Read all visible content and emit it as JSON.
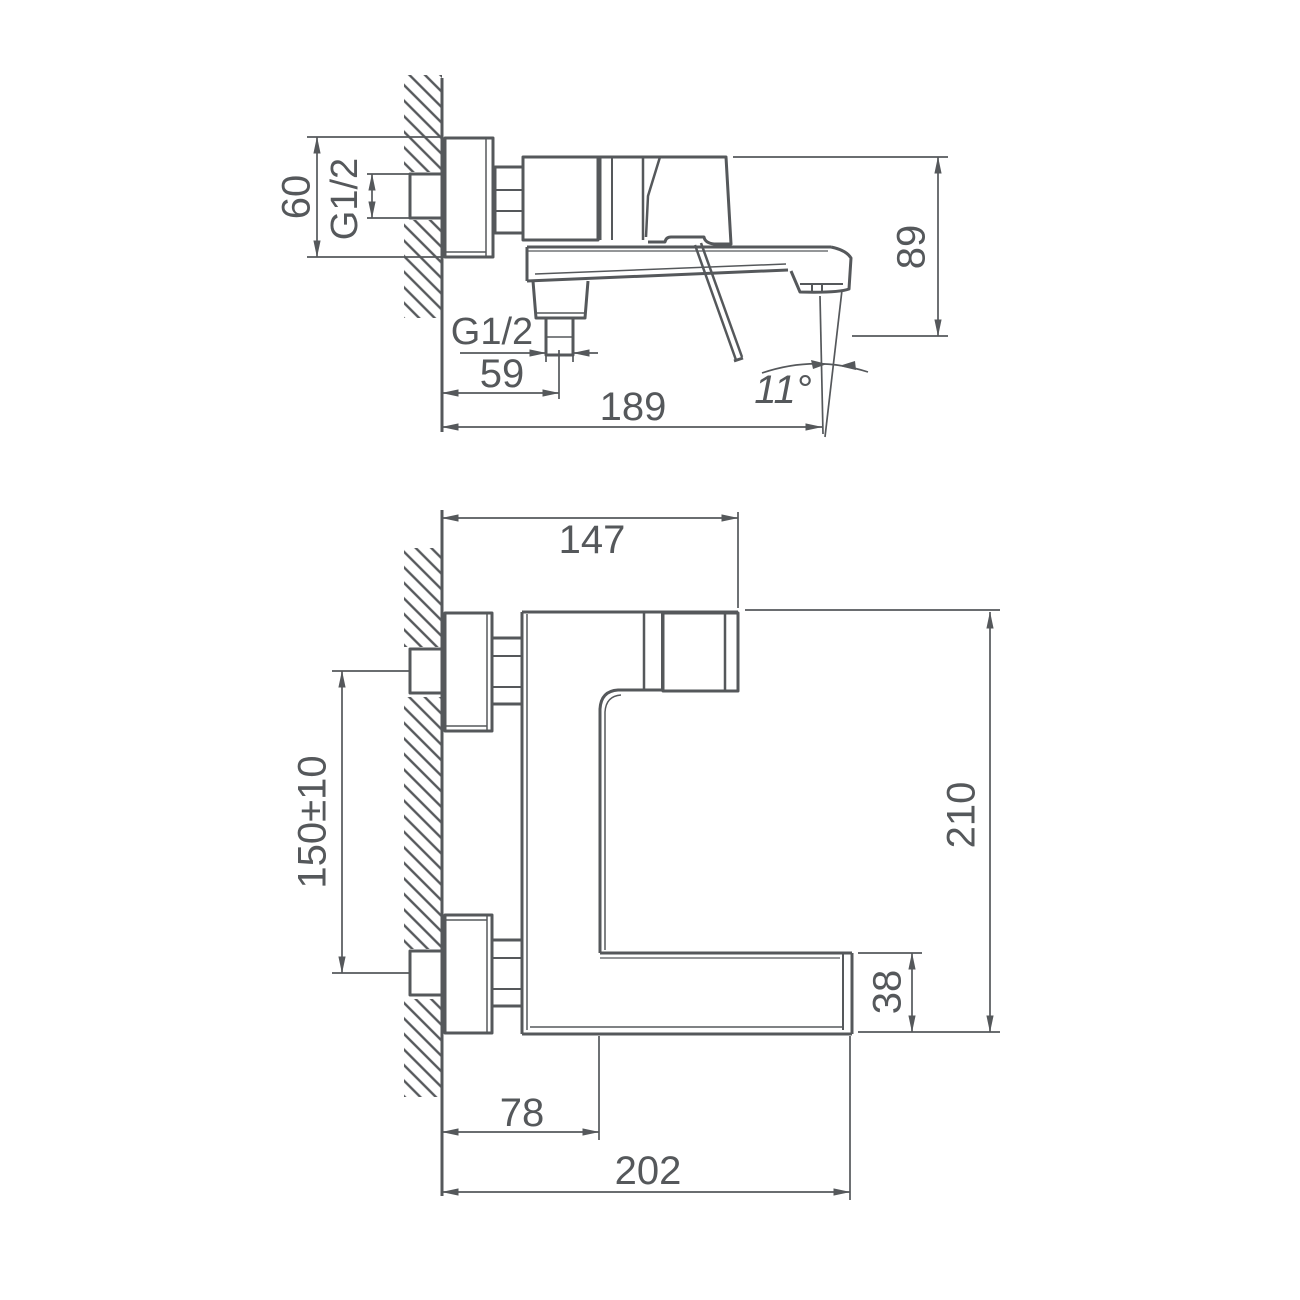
{
  "document": {
    "type": "technical-dimension-drawing",
    "subject": "wall-mounted single-lever bath mixer faucet, two orthographic views",
    "background_color": "#ffffff",
    "line_color": "#55585b"
  },
  "dims": {
    "d60": "60",
    "g12_inlet": "G1/2",
    "d89": "89",
    "g12_outlet": "G1/2",
    "d59": "59",
    "d189": "189",
    "a11": "11°",
    "d147": "147",
    "d150": "150±10",
    "d210": "210",
    "d38": "38",
    "d78": "78",
    "d202": "202"
  },
  "views": {
    "side_view": {
      "label": "side view (spout profile)",
      "dimensions": [
        "60",
        "G1/2",
        "G1/2",
        "59",
        "189",
        "89",
        "11°"
      ]
    },
    "front_view": {
      "label": "front view (rotated 90°)",
      "dimensions": [
        "147",
        "150±10",
        "210",
        "38",
        "78",
        "202"
      ]
    }
  }
}
